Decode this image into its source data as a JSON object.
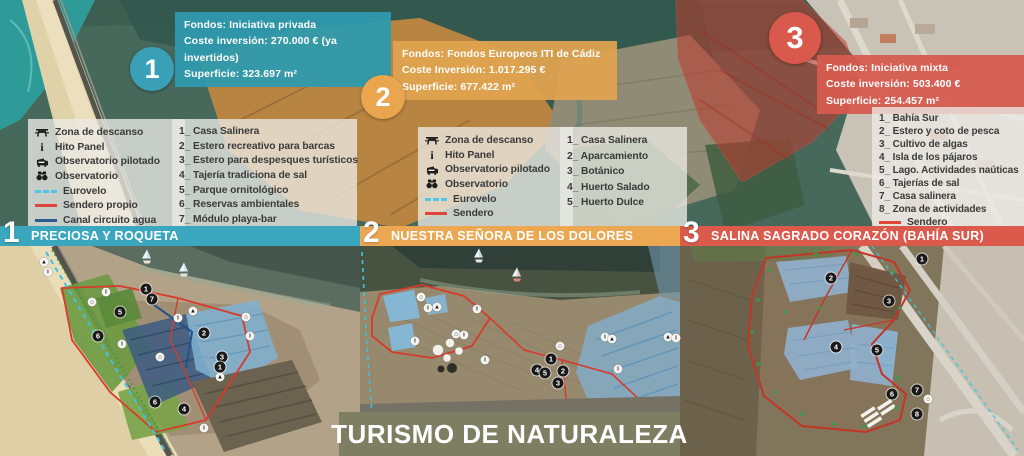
{
  "footer": {
    "label": "TURISMO DE NATURALEZA",
    "bg": "#7E7E62"
  },
  "areas": [
    {
      "number": "1",
      "fondos": "Fondos: Iniciativa privada",
      "coste": "Coste inversión: 270.000 € (ya invertidos)",
      "superficie": "Superficie: 323.697 m²",
      "box_color": "rgba(46,154,173,0.95)",
      "circle_color": "#3AA0B8"
    },
    {
      "number": "2",
      "fondos": "Fondos: Fondos Europeos ITI de Cádiz",
      "coste": "Coste Inversión: 1.017.295 €",
      "superficie": "Superficie: 677.422 m²",
      "box_color": "rgba(223,163,80,0.95)",
      "circle_color": "#E9A64F"
    },
    {
      "number": "3",
      "fondos": "Fondos: Iniciativa mixta",
      "coste": "Coste inversión: 503.400 €",
      "superficie": "Superficie: 254.457 m²",
      "box_color": "rgba(214,91,79,0.95)",
      "circle_color": "#D9594C"
    }
  ],
  "sections": [
    {
      "number": "1",
      "title": "PRECIOSA Y ROQUETA",
      "color": "#3BA7BE"
    },
    {
      "number": "2",
      "title": "NUESTRA SEÑORA DE LOS DOLORES",
      "color": "#EBA751"
    },
    {
      "number": "3",
      "title": "SALINA SAGRADO CORAZÓN (BAHÍA SUR)",
      "color": "#DB5A4C"
    }
  ],
  "legend1": {
    "icons": [
      {
        "label": "Zona de descanso"
      },
      {
        "label": "Hito Panel"
      },
      {
        "label": "Observatorio pilotado"
      },
      {
        "label": "Observatorio"
      }
    ],
    "lines": [
      {
        "label": "Eurovelo",
        "color": "#4FC3E8",
        "style": "dashed"
      },
      {
        "label": "Sendero propio",
        "color": "#E0453A",
        "style": "solid"
      },
      {
        "label": "Canal circuito agua",
        "color": "#2B5C8F",
        "style": "solid"
      }
    ]
  },
  "legend2": {
    "icons": [
      {
        "label": "Zona de descanso"
      },
      {
        "label": "Hito Panel"
      },
      {
        "label": "Observatorio pilotado"
      },
      {
        "label": "Observatorio"
      }
    ],
    "lines": [
      {
        "label": "Eurovelo",
        "color": "#4FC3E8",
        "style": "dashed"
      },
      {
        "label": "Sendero",
        "color": "#E0453A",
        "style": "solid"
      }
    ]
  },
  "list1": {
    "items": [
      "1_ Casa Salinera",
      "2_ Estero recreativo para barcas",
      "3_ Estero para despesques turísticos",
      "4_ Tajería tradiciona de sal",
      "5_ Parque ornitológico",
      "6_ Reservas ambientales",
      "7_ Módulo playa-bar"
    ]
  },
  "list2": {
    "items": [
      "1_ Casa Salinera",
      "2_ Aparcamiento",
      "3_ Botánico",
      "4_ Huerto Salado",
      "5_ Huerto Dulce"
    ]
  },
  "list3": {
    "items": [
      "1_ Bahía Sur",
      "2_ Estero y coto de pesca",
      "3_ Cultivo de algas",
      "4_ Isla de los pájaros",
      "5_ Lago. Actividades naúticas",
      "6_ Tajerías de sal",
      "7_ Casa salinera",
      "8_ Zona de actividades"
    ],
    "line": {
      "label": "Sendero",
      "color": "#E0453A",
      "style": "solid"
    }
  },
  "markers": {
    "panel1_numbers": [
      {
        "n": "1",
        "x": 146,
        "y": 289
      },
      {
        "n": "7",
        "x": 152,
        "y": 299
      },
      {
        "n": "5",
        "x": 120,
        "y": 312
      },
      {
        "n": "6",
        "x": 98,
        "y": 336
      },
      {
        "n": "2",
        "x": 204,
        "y": 333
      },
      {
        "n": "3",
        "x": 222,
        "y": 357
      },
      {
        "n": "1",
        "x": 220,
        "y": 367
      },
      {
        "n": "6",
        "x": 155,
        "y": 402
      },
      {
        "n": "4",
        "x": 184,
        "y": 409
      }
    ],
    "panel1_icons": [
      {
        "g": "▲",
        "x": 44,
        "y": 262
      },
      {
        "g": "i",
        "x": 48,
        "y": 272
      },
      {
        "g": "i",
        "x": 106,
        "y": 292
      },
      {
        "g": "⌂",
        "x": 92,
        "y": 302
      },
      {
        "g": "i",
        "x": 122,
        "y": 344
      },
      {
        "g": "⌂",
        "x": 160,
        "y": 357
      },
      {
        "g": "i",
        "x": 178,
        "y": 318
      },
      {
        "g": "▲",
        "x": 193,
        "y": 311
      },
      {
        "g": "⌂",
        "x": 246,
        "y": 317
      },
      {
        "g": "i",
        "x": 250,
        "y": 336
      },
      {
        "g": "▲",
        "x": 220,
        "y": 377
      },
      {
        "g": "i",
        "x": 204,
        "y": 428
      }
    ],
    "panel2_numbers": [
      {
        "n": "1",
        "x": 551,
        "y": 359
      },
      {
        "n": "4",
        "x": 537,
        "y": 370
      },
      {
        "n": "5",
        "x": 545,
        "y": 373
      },
      {
        "n": "2",
        "x": 563,
        "y": 371
      },
      {
        "n": "3",
        "x": 558,
        "y": 383
      }
    ],
    "panel2_icons": [
      {
        "g": "⌂",
        "x": 421,
        "y": 297
      },
      {
        "g": "i",
        "x": 428,
        "y": 308
      },
      {
        "g": "▲",
        "x": 437,
        "y": 307
      },
      {
        "g": "i",
        "x": 415,
        "y": 341
      },
      {
        "g": "⌂",
        "x": 456,
        "y": 334
      },
      {
        "g": "i",
        "x": 464,
        "y": 335
      },
      {
        "g": "i",
        "x": 477,
        "y": 309
      },
      {
        "g": "i",
        "x": 485,
        "y": 360
      },
      {
        "g": "⌂",
        "x": 560,
        "y": 346
      },
      {
        "g": "i",
        "x": 605,
        "y": 337
      },
      {
        "g": "▲",
        "x": 612,
        "y": 339
      },
      {
        "g": "i",
        "x": 618,
        "y": 369
      },
      {
        "g": "▲",
        "x": 668,
        "y": 337
      },
      {
        "g": "i",
        "x": 676,
        "y": 338
      }
    ],
    "panel3_numbers": [
      {
        "n": "1",
        "x": 922,
        "y": 259
      },
      {
        "n": "2",
        "x": 831,
        "y": 278
      },
      {
        "n": "3",
        "x": 889,
        "y": 301
      },
      {
        "n": "4",
        "x": 836,
        "y": 347
      },
      {
        "n": "5",
        "x": 877,
        "y": 350
      },
      {
        "n": "6",
        "x": 892,
        "y": 394
      },
      {
        "n": "7",
        "x": 917,
        "y": 390
      },
      {
        "n": "8",
        "x": 917,
        "y": 414
      }
    ],
    "panel3_icons": [
      {
        "g": "⌂",
        "x": 928,
        "y": 399
      }
    ]
  }
}
